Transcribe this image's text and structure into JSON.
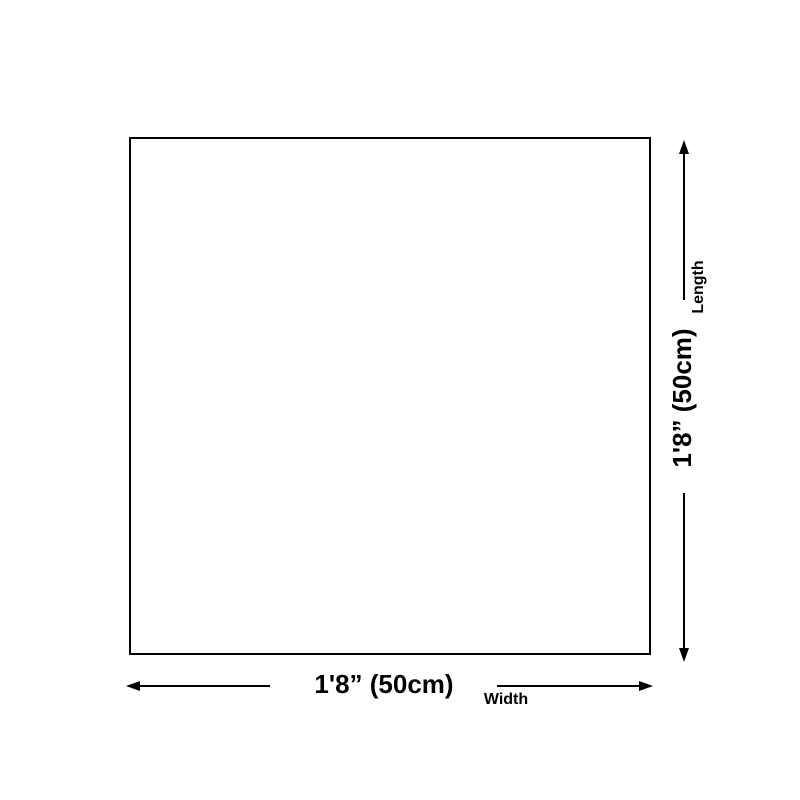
{
  "diagram": {
    "shape": "square-outline",
    "background_color": "#ffffff",
    "line_color": "#000000"
  },
  "length_dimension": {
    "value": "1'8” (50cm)",
    "label": "Length"
  },
  "width_dimension": {
    "value": "1'8” (50cm)",
    "label": "Width"
  }
}
